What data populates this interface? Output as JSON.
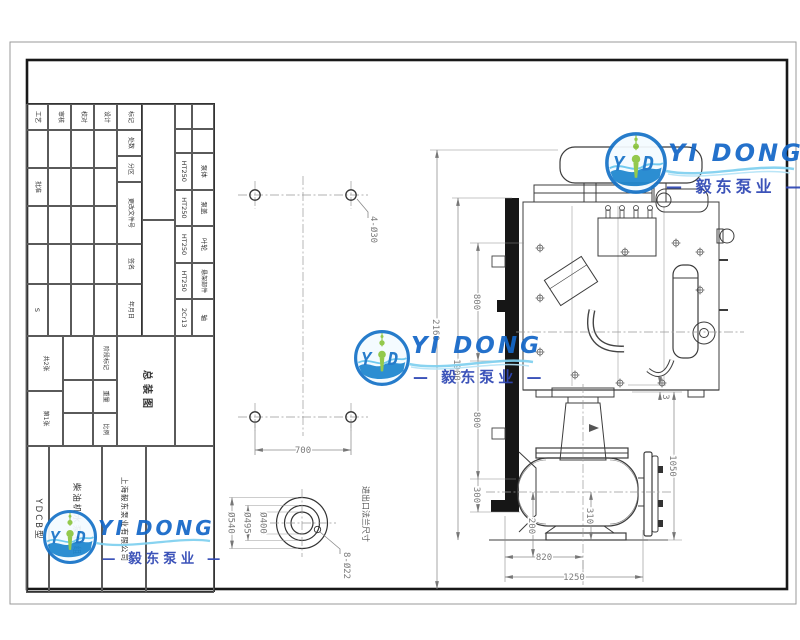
{
  "watermark": {
    "brand_en": "YI DONG",
    "brand_cn": "— 毅东泵业 —",
    "logo": {
      "letter_left": "Y",
      "letter_right": "D"
    }
  },
  "title_block": {
    "revision_row": {
      "mark": "标记",
      "count": "处数",
      "zone": "分区",
      "doc_no": "更改文件号",
      "sign": "签名",
      "date": "年月日"
    },
    "roles": {
      "design": "设计",
      "check": "校对",
      "audit": "审核",
      "process": "工艺",
      "approve": "批准"
    },
    "stage": {
      "stage_mark": "阶段标记",
      "weight": "重量",
      "scale": "比例",
      "weight_value": "S",
      "sheets": "共2张",
      "sheet_no": "第1张"
    },
    "drawing_title": "总装图",
    "company": "上海毅东泵业有限公司",
    "product": "柴油机水泵机组",
    "model": "YDCB型"
  },
  "bom": {
    "parts": [
      "泵体",
      "泵盖",
      "叶轮",
      "悬架部件",
      "轴"
    ],
    "materials": [
      "HT250",
      "HT250",
      "HT250",
      "HT250",
      "2Cr13"
    ]
  },
  "plate_view": {
    "holes_label": "4-Ø30",
    "width": "700"
  },
  "flange_view": {
    "d_outer": "Ø540",
    "d_bolt": "Ø495",
    "d_inner": "Ø400",
    "holes": "8-Ø22",
    "caption": "进出口法兰尺寸"
  },
  "main_view": {
    "total_height": "2160",
    "frame_height": "1900",
    "seg_top": "800",
    "seg_mid": "800",
    "seg_bottom": "300",
    "gap": "3",
    "pump_height": "1050",
    "outlet_height": "310",
    "inlet_height": "200",
    "base_to_axis": "820",
    "base_length": "1250"
  }
}
